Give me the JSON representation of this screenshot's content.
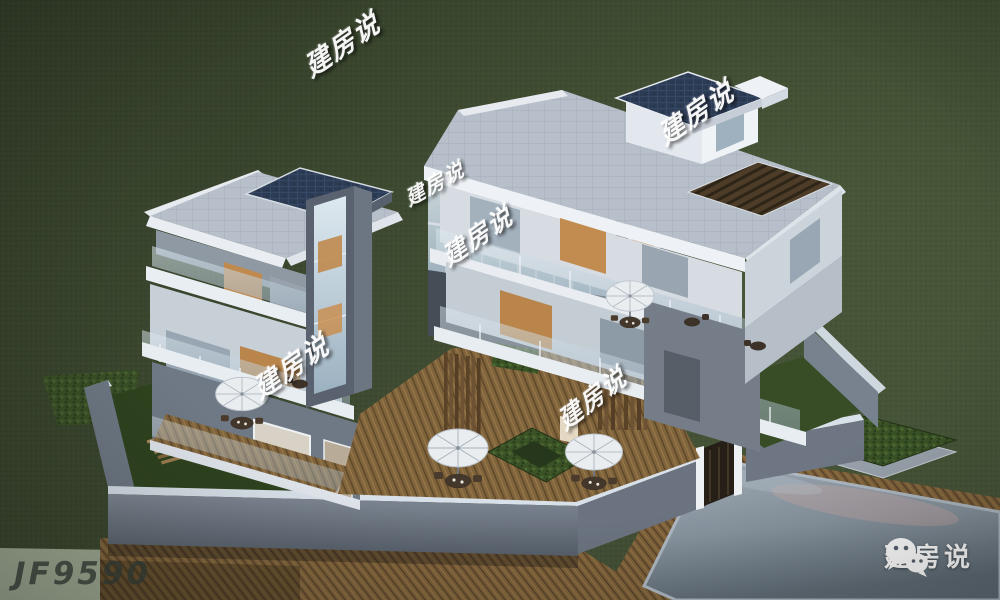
{
  "scene": {
    "description": "Dusk aerial 3D rendering of a modern U-shaped flat-roof villa (two white 3-storey wings joined by a glass corridor), glass balcony railings, dark-blue tiled roof accents, wooden deck courtyard with parasols and a hedge planter, perimeter wall with iron gate, reflecting pool at lower right, surrounded by lawn",
    "colors": {
      "grass_dark": "#35402a",
      "grass_light": "#4a583b",
      "roof_tile": "#b7c0ca",
      "blue_roof": "#2d3c55",
      "wall_white": "#eef1f5",
      "wall_gray": "#6d7680",
      "wood_deck": "#7d6038",
      "pool_water": "#8b97a2",
      "pool_sheen": "#c9a8a0",
      "watermark": "#ffffff"
    }
  },
  "watermarks": [
    {
      "text": "建房说"
    },
    {
      "text": "建房说"
    },
    {
      "text": "建房说"
    },
    {
      "text": "建房说"
    },
    {
      "text": "建房说"
    },
    {
      "text": "建房说"
    }
  ],
  "plan_code": "JF9590",
  "brand": {
    "name": "建房说",
    "icon": "wechat-icon"
  }
}
